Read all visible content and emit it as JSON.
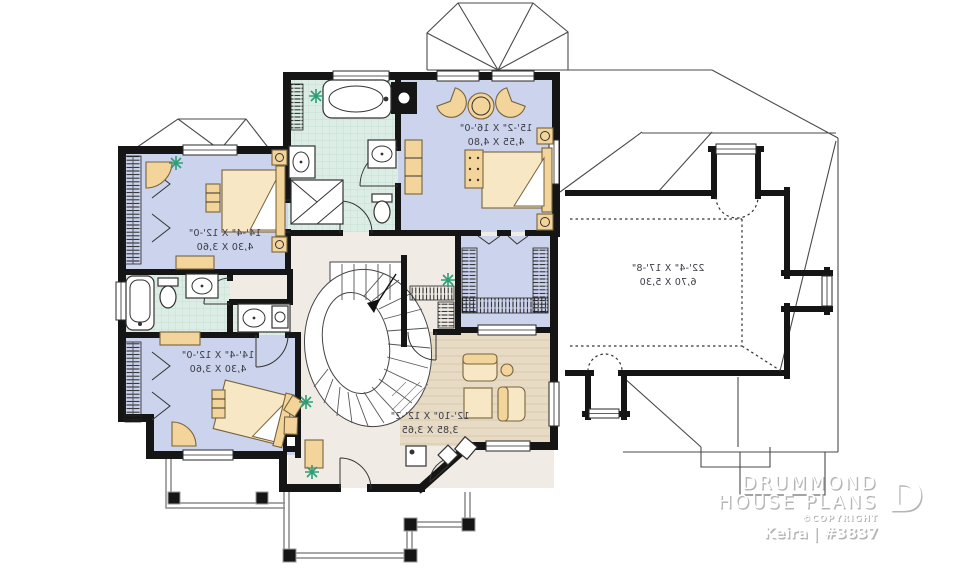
{
  "branding": {
    "name_line1": "DRUMMOND",
    "name_line2": "HOUSE PLANS",
    "copyright": "©COPYRIGHT",
    "plan_name": "Keira | #3837",
    "logo_letter": "D"
  },
  "rooms": {
    "master_bedroom": {
      "imperial": "15'-2\" X 16'-0\"",
      "metric": "4,55 X 4,80"
    },
    "bedroom_2": {
      "imperial": "14'-4\" X 12'-0\"",
      "metric": "4,30 X 3,60"
    },
    "bedroom_3": {
      "imperial": "14'-4\" X 12'-0\"",
      "metric": "4,30 X 3,60"
    },
    "bonus_room": {
      "imperial": "22'-4\" X 17'-8\"",
      "metric": "6,70 X 5,30"
    },
    "sitting_room": {
      "imperial": "12'-10\" X 12'-2\"",
      "metric": "3,85 X 3,65"
    }
  },
  "colors": {
    "wall": "#151515",
    "bedroom_floor": "#ccd3ec",
    "bath_floor": "#dcede6",
    "wood_floor": "#e7dbc5",
    "hall_floor": "#f0ece5",
    "furniture": "#f3d49b",
    "furniture_light": "#f8e7c4",
    "plant": "#2e9e78",
    "roof_line": "#4a4a4a",
    "logo_shadow": "#b5b5b5"
  }
}
